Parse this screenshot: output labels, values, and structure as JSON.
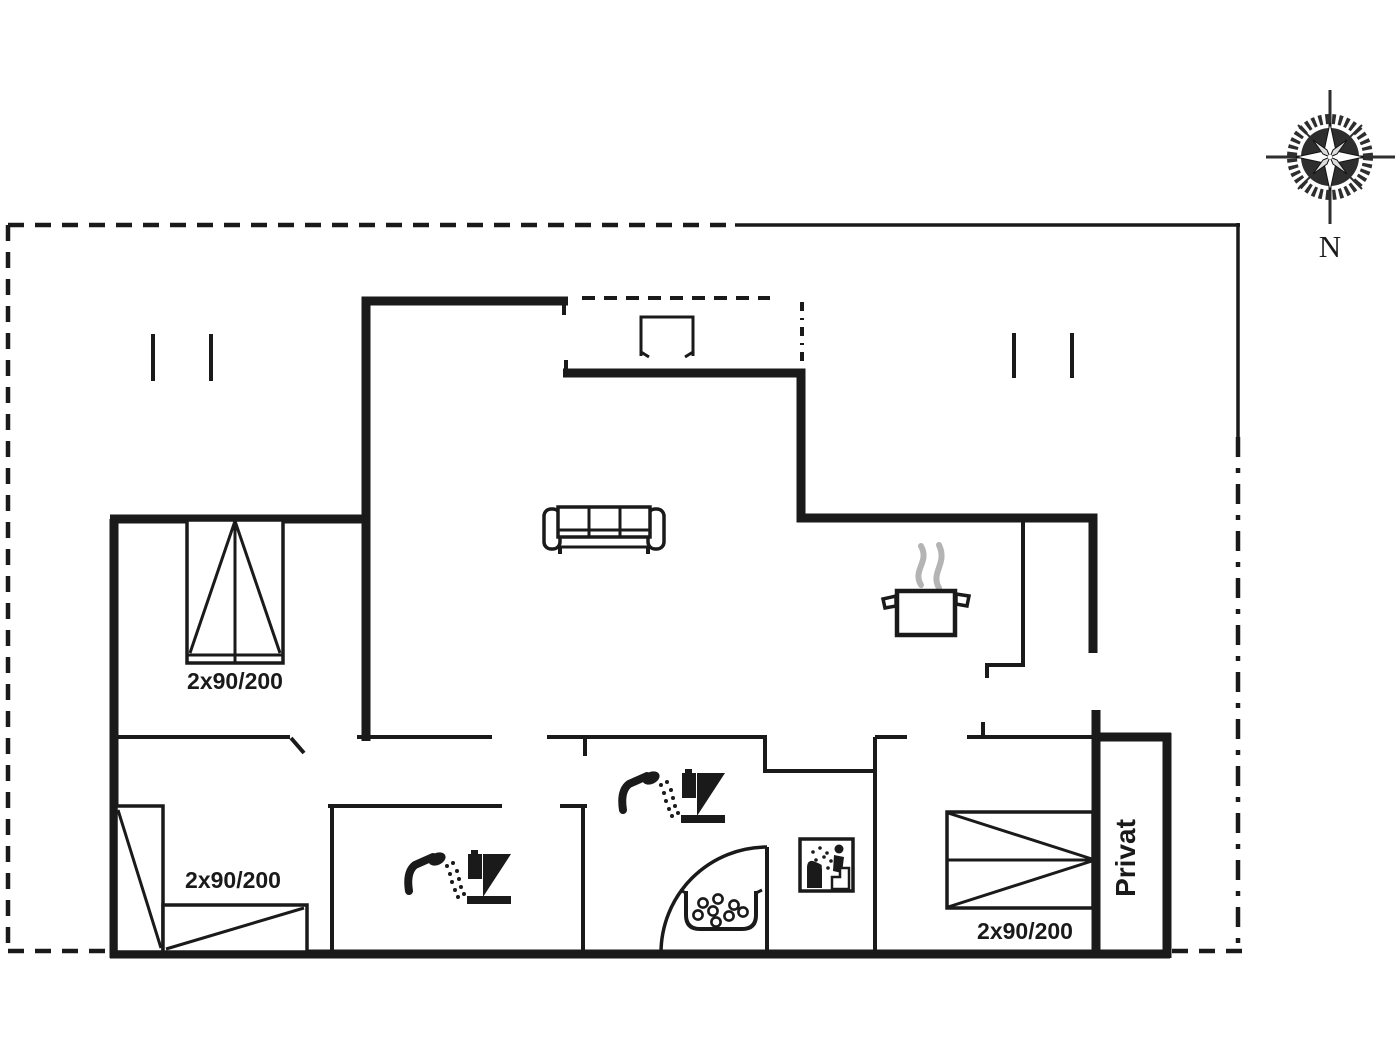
{
  "canvas": {
    "background": "#ffffff",
    "ink": "#1a1a1a",
    "steam_color": "#b4b4b4",
    "compass_color": "#2e2e2e"
  },
  "labels": {
    "bed_top_left": "2x90/200",
    "bed_bottom_left": "2x90/200",
    "bed_right": "2x90/200",
    "private_room": "Privat",
    "compass_north": "N"
  },
  "icons": [
    "compass-rose-icon",
    "sofa-icon",
    "double-bed-icon",
    "corner-bed-icon",
    "cooking-pot-icon",
    "shower-icon",
    "toilet-icon",
    "door-swing-icon",
    "stone-bowl-icon",
    "utility-appliance-icon",
    "terrace-table-icon",
    "terrace-post-icon"
  ]
}
